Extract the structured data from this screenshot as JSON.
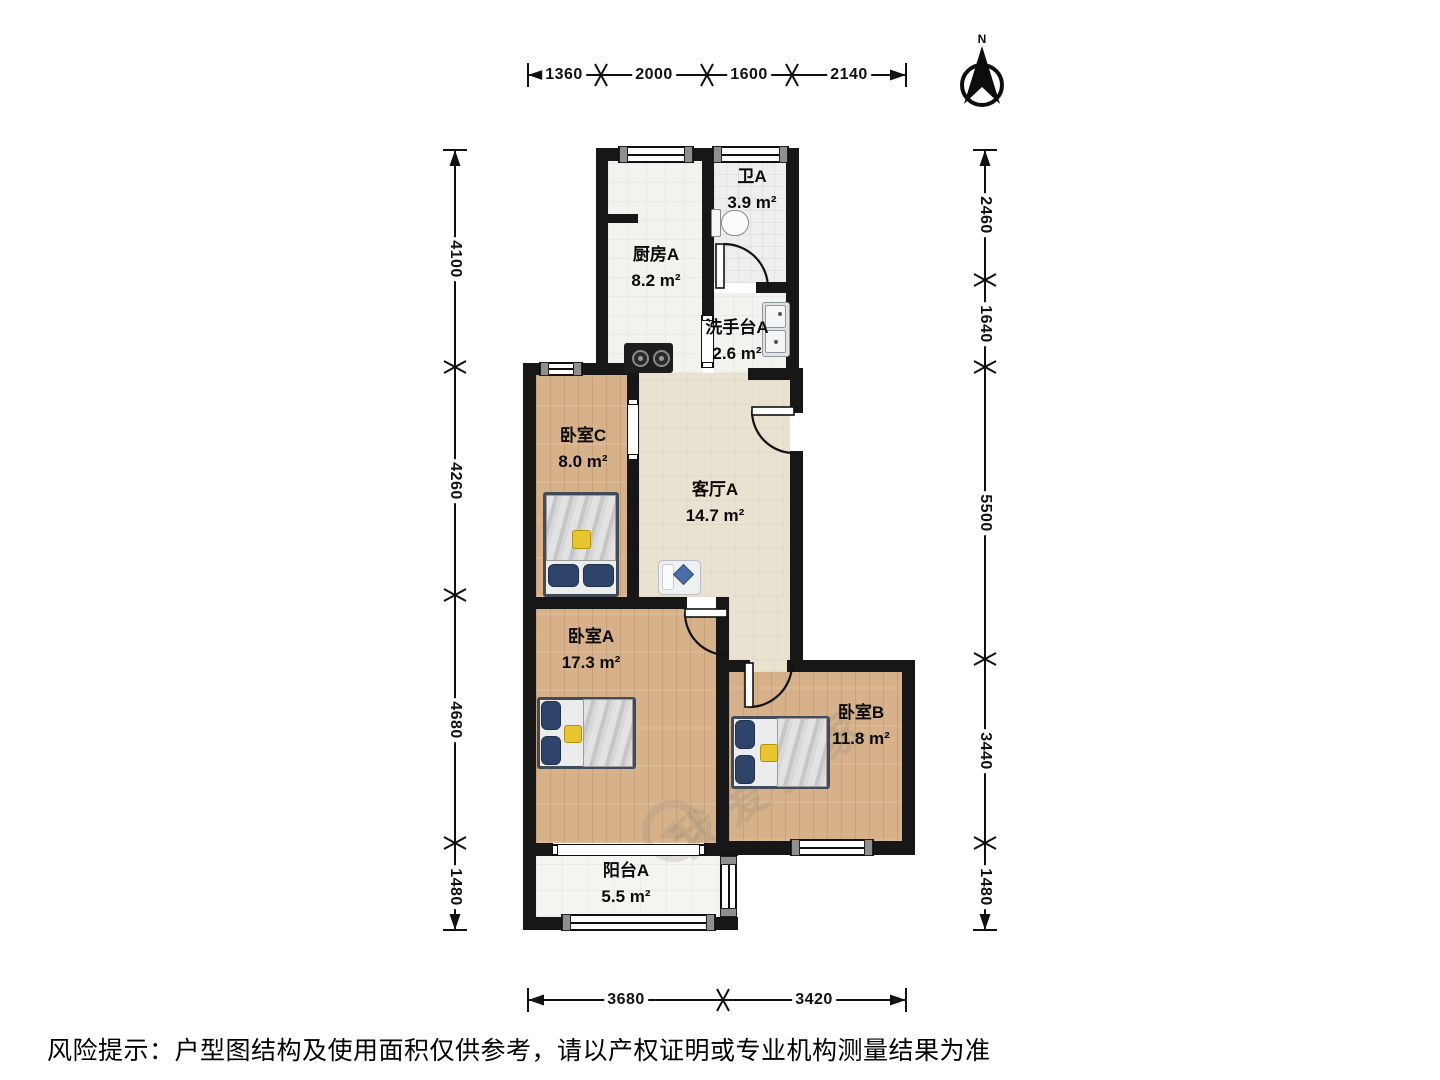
{
  "compass": {
    "label": "N"
  },
  "rooms": {
    "kitchen": {
      "name": "厨房A",
      "area": "8.2 m²"
    },
    "bath": {
      "name": "卫A",
      "area": "3.9 m²"
    },
    "washstand": {
      "name": "洗手台A",
      "area": "2.6 m²"
    },
    "bedroom_c": {
      "name": "卧室C",
      "area": "8.0 m²"
    },
    "living": {
      "name": "客厅A",
      "area": "14.7 m²"
    },
    "bedroom_a": {
      "name": "卧室A",
      "area": "17.3 m²"
    },
    "bedroom_b": {
      "name": "卧室B",
      "area": "11.8 m²"
    },
    "balcony": {
      "name": "阳台A",
      "area": "5.5 m²"
    }
  },
  "dims": {
    "top": [
      "1360",
      "2000",
      "1600",
      "2140"
    ],
    "left": [
      "4100",
      "4260",
      "4680",
      "1480"
    ],
    "right": [
      "2460",
      "1640",
      "5500",
      "3440",
      "1480"
    ],
    "bottom": [
      "3680",
      "3420"
    ]
  },
  "watermark": "我爱我家",
  "disclaimer": "风险提示：户型图结构及使用面积仅供参考，请以产权证明或专业机构测量结果为准",
  "colors": {
    "wall": "#171717",
    "wood_floor": "#d6b189",
    "living_floor": "#eae2d1",
    "tile_floor": "#f2f2ef",
    "pillow_blue": "#2e4569"
  }
}
